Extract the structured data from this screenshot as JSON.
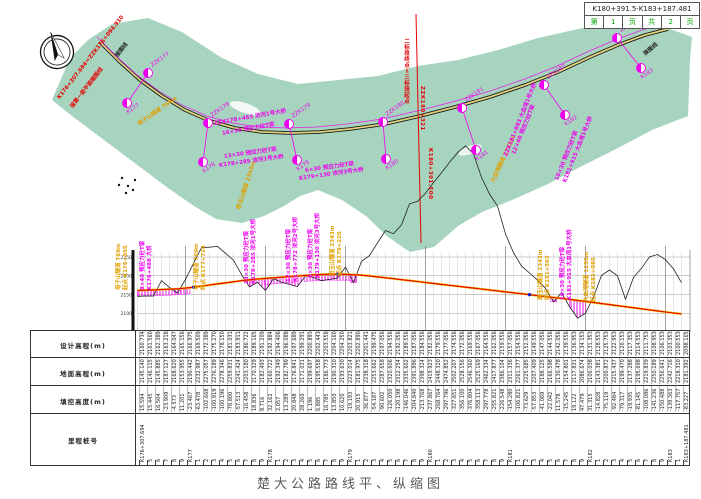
{
  "title_block": {
    "range": "K180+391.5-K183+187.481",
    "cells": [
      "第",
      "1",
      "页",
      "共",
      "2",
      "页"
    ]
  },
  "caption": "楚大公路路线平、纵缩图",
  "colors": {
    "map_band": "#a7d4bf",
    "magenta": "#ee00ee",
    "yellow_label": "#e0a000",
    "red": "#e60000",
    "green_text": "#00a500",
    "design_line": "#e60000",
    "ground_line": "#222222"
  },
  "map": {
    "stations": [
      {
        "upper": "ZZK177",
        "ux": 148,
        "uy": 73,
        "lower": "K177",
        "lx": 127,
        "ly": 103
      },
      {
        "upper": "ZZK178",
        "ux": 208,
        "uy": 123,
        "lower": "K178",
        "lx": 203,
        "ly": 162
      },
      {
        "upper": "ZZK179",
        "ux": 289,
        "uy": 124,
        "lower": "K179",
        "lx": 297,
        "ly": 160
      },
      {
        "upper": "ZZK180",
        "ux": 383,
        "uy": 122,
        "lower": "K180",
        "lx": 386,
        "ly": 159
      },
      {
        "upper": "ZZK181",
        "ux": 462,
        "uy": 108,
        "lower": "K181",
        "lx": 476,
        "ly": 150
      },
      {
        "upper": "ZZK182",
        "ux": 544,
        "uy": 85,
        "lower": "K182",
        "lx": 565,
        "ly": 115
      },
      {
        "upper": "ZZK183",
        "ux": 617,
        "uy": 38,
        "lower": "K183",
        "lx": 641,
        "ly": 68
      }
    ],
    "labels": [
      {
        "text": "K176+307.694＝ZZK176+094.910",
        "x": 58,
        "y": 94,
        "rot": -52,
        "color": "#e60000"
      },
      {
        "text": "接第一册平面缩图线",
        "x": 71,
        "y": 103,
        "rot": -52,
        "color": "#e60000"
      },
      {
        "text": "接图线",
        "x": 116,
        "y": 52,
        "rot": -52,
        "color": "#222222"
      },
      {
        "text": "母子山隧道 769m",
        "x": 138,
        "y": 120,
        "rot": -35,
        "color": "#e0a000"
      },
      {
        "text": "斑玉山隧道 2343m",
        "x": 238,
        "y": 205,
        "rot": -72,
        "color": "#e0a000"
      },
      {
        "text": "大血湾隧道 1255m",
        "x": 492,
        "y": 178,
        "rot": -65,
        "color": "#e0a000"
      },
      {
        "text": "ZZK178+465 浓河1号大桥",
        "x": 214,
        "y": 119,
        "rot": -10,
        "color": "#ee00ee"
      },
      {
        "text": "16×30 预应力砼T梁",
        "x": 222,
        "y": 129,
        "rot": -10,
        "color": "#ee00ee"
      },
      {
        "text": "13×30 预应力砼T梁",
        "x": 224,
        "y": 152,
        "rot": -8,
        "color": "#ee00ee"
      },
      {
        "text": "K178+285 浓河1号大桥",
        "x": 219,
        "y": 161,
        "rot": -8,
        "color": "#ee00ee"
      },
      {
        "text": "6×30 预应力砼T梁",
        "x": 305,
        "y": 166,
        "rot": -8,
        "color": "#ee00ee"
      },
      {
        "text": "K179+130 浓河3号大桥",
        "x": 299,
        "y": 174,
        "rot": -8,
        "color": "#ee00ee"
      },
      {
        "text": "ZZK181+883 大血湾1号大桥",
        "x": 505,
        "y": 152,
        "rot": -68,
        "color": "#ee00ee"
      },
      {
        "text": "12×40 预应力砼T梁",
        "x": 513,
        "y": 150,
        "rot": -68,
        "color": "#ee00ee"
      },
      {
        "text": "10×30 预应力砼T梁",
        "x": 556,
        "y": 176,
        "rot": -68,
        "color": "#ee00ee"
      },
      {
        "text": "K181+915 大血湾1号大桥",
        "x": 564,
        "y": 178,
        "rot": -68,
        "color": "#ee00ee"
      },
      {
        "text": "接图线",
        "x": 644,
        "y": 50,
        "rot": -40,
        "color": "#222222"
      }
    ],
    "boundary": {
      "texts": [
        {
          "text": "二标段终点＝三标段起点",
          "x": 402,
          "y": 38,
          "color": "#e60000"
        },
        {
          "text": "ZZK180+321",
          "x": 419,
          "y": 86,
          "color": "#e60000"
        },
        {
          "text": "K180+391.500",
          "x": 427,
          "y": 148,
          "color": "#e60000"
        }
      ]
    }
  },
  "profile": {
    "axis_labels": [
      "2250",
      "2200",
      "2150",
      "2100",
      "2050"
    ],
    "labels": [
      {
        "lines": [
          "母子山隧道 769m",
          "起点 K176+955"
        ],
        "x": 116,
        "y": 290,
        "color": "#e0a000"
      },
      {
        "lines": [
          "8×40 预应力砼T梁",
          "K176+488 大桥"
        ],
        "x": 140,
        "y": 290,
        "color": "#ee00ee"
      },
      {
        "lines": [
          "母子山隧道 769m",
          "终点 K177+724"
        ],
        "x": 194,
        "y": 290,
        "color": "#e0a000"
      },
      {
        "lines": [
          "13×30 预应力砼T梁",
          "K178+285 浓河1号大桥"
        ],
        "x": 244,
        "y": 284,
        "color": "#ee00ee"
      },
      {
        "lines": [
          "12×30 预应力砼T梁",
          "K178+772 浓河2号大桥"
        ],
        "x": 286,
        "y": 282,
        "color": "#ee00ee"
      },
      {
        "lines": [
          "6×30 预应力砼T梁",
          "K179+130 浓河3号大桥"
        ],
        "x": 308,
        "y": 278,
        "color": "#ee00ee"
      },
      {
        "lines": [
          "斑玉山隧道 2343m",
          "起点 K179+220"
        ],
        "x": 330,
        "y": 276,
        "color": "#e0a000"
      },
      {
        "lines": [
          "斑玉山隧道 2343m",
          "终点 K181+563"
        ],
        "x": 538,
        "y": 300,
        "color": "#e0a000"
      },
      {
        "lines": [
          "10×30 预应力砼T梁",
          "K181+915 大血湾1号大桥"
        ],
        "x": 560,
        "y": 300,
        "color": "#ee00ee"
      },
      {
        "lines": [
          "大血湾隧道 1255m",
          "起点 K182+085"
        ],
        "x": 584,
        "y": 302,
        "color": "#e0a000"
      }
    ]
  },
  "table": {
    "row_labels": [
      "设计高程(m)",
      "地面高程(m)",
      "填挖高度(m)",
      "里程桩号"
    ]
  },
  "chart_data": {
    "type": "line",
    "title": "楚大公路路线纵断面",
    "ylabel": "高程(m)",
    "ylim": [
      2050,
      2250
    ],
    "grid": true,
    "x_stations": [
      "K176+307.694",
      "5",
      "6",
      "7",
      "8",
      "9",
      "K177",
      "1",
      "2",
      "3",
      "4",
      "5",
      "6",
      "7",
      "8",
      "9",
      "K178",
      "1",
      "2",
      "3",
      "4",
      "5",
      "6",
      "7",
      "8",
      "9",
      "K179",
      "1",
      "2",
      "3",
      "4",
      "5",
      "6",
      "7",
      "8",
      "9",
      "K180",
      "1",
      "2",
      "3",
      "4",
      "5",
      "6",
      "7",
      "8",
      "9",
      "K181",
      "1",
      "2",
      "3",
      "4",
      "5",
      "6",
      "7",
      "8",
      "9",
      "K182",
      "1",
      "2",
      "3",
      "4",
      "5",
      "6",
      "7",
      "8",
      "9",
      "K183",
      "1",
      "K183+187.481"
    ],
    "series": [
      {
        "name": "设计高程",
        "values": [
          2160.734,
          2161.56,
          2162.389,
          2163.218,
          2164.047,
          2165.156,
          2166.975,
          2169.509,
          2172.389,
          2175.27,
          2178.15,
          2181.031,
          2183.911,
          2186.722,
          2189.165,
          2191.209,
          2192.884,
          2194.406,
          2196.088,
          2197.689,
          2199.291,
          2200.893,
          2202.443,
          2203.558,
          2204.16,
          2204.25,
          2203.821,
          2202.89,
          2201.441,
          2199.475,
          2197.056,
          2194.556,
          2192.056,
          2189.556,
          2187.056,
          2184.556,
          2182.056,
          2179.556,
          2177.056,
          2174.556,
          2172.056,
          2169.556,
          2167.056,
          2164.556,
          2162.056,
          2159.556,
          2157.056,
          2154.556,
          2152.056,
          2149.556,
          2147.056,
          2144.556,
          2142.056,
          2139.556,
          2136.953,
          2134.153,
          2131.353,
          2128.553,
          2125.753,
          2122.953,
          2120.153,
          2117.353,
          2114.553,
          2111.753,
          2108.953,
          2106.153,
          2103.353,
          2100.553,
          2098.165
        ]
      },
      {
        "name": "地面高程",
        "values": [
          2145.14,
          2146.115,
          2145.885,
          2187.127,
          2168.62,
          2153.955,
          2190.442,
          2232.987,
          2275.057,
          2276.189,
          2278.346,
          2259.831,
          2241.424,
          2203.18,
          2170.329,
          2182.493,
          2160.722,
          2192.349,
          2182.799,
          2176.841,
          2171.031,
          2199.697,
          2195.558,
          2186.773,
          2190.31,
          2193.63,
          2223.014,
          2181.975,
          2238.318,
          2253.662,
          2287.658,
          2320.606,
          2312.254,
          2335.602,
          2391.896,
          2398.324,
          2419.923,
          2448.32,
          2474.852,
          2502.207,
          2528.156,
          2546.36,
          2525.169,
          2462.334,
          2417.877,
          2386.104,
          2311.336,
          2261.377,
          2225.685,
          2207.409,
          2188.125,
          2166.598,
          2130.478,
          2154.801,
          2117.831,
          2086.674,
          2100.038,
          2143.381,
          2200.872,
          2215.437,
          2199.47,
          2137.288,
          2195.698,
          2219.839,
          2250.189,
          2256.641,
          2242.716,
          2218.31,
          2181.392
        ]
      },
      {
        "name": "填挖高度",
        "values": [
          15.594,
          15.445,
          16.504,
          -23.909,
          -4.573,
          11.201,
          -23.467,
          -63.478,
          -102.668,
          -100.919,
          -100.196,
          -78.8,
          -57.513,
          -16.458,
          18.836,
          8.716,
          32.162,
          2.057,
          13.289,
          20.848,
          28.26,
          1.196,
          6.885,
          16.785,
          13.85,
          10.62,
          -19.193,
          20.915,
          -36.877,
          -54.187,
          -90.602,
          -126.05,
          -120.198,
          -146.046,
          -204.84,
          -213.768,
          -237.867,
          -268.764,
          -297.796,
          -327.651,
          -356.1,
          -376.804,
          -358.113,
          -297.778,
          -255.821,
          -226.548,
          -154.28,
          -106.821,
          -73.629,
          -57.853,
          -41.069,
          -22.042,
          11.578,
          -15.245,
          19.122,
          47.479,
          31.315,
          -14.828,
          -75.119,
          -92.484,
          -79.317,
          -19.935,
          -81.145,
          -108.086,
          -141.236,
          -150.488,
          -139.363,
          -117.757,
          -83.227
        ]
      }
    ]
  }
}
